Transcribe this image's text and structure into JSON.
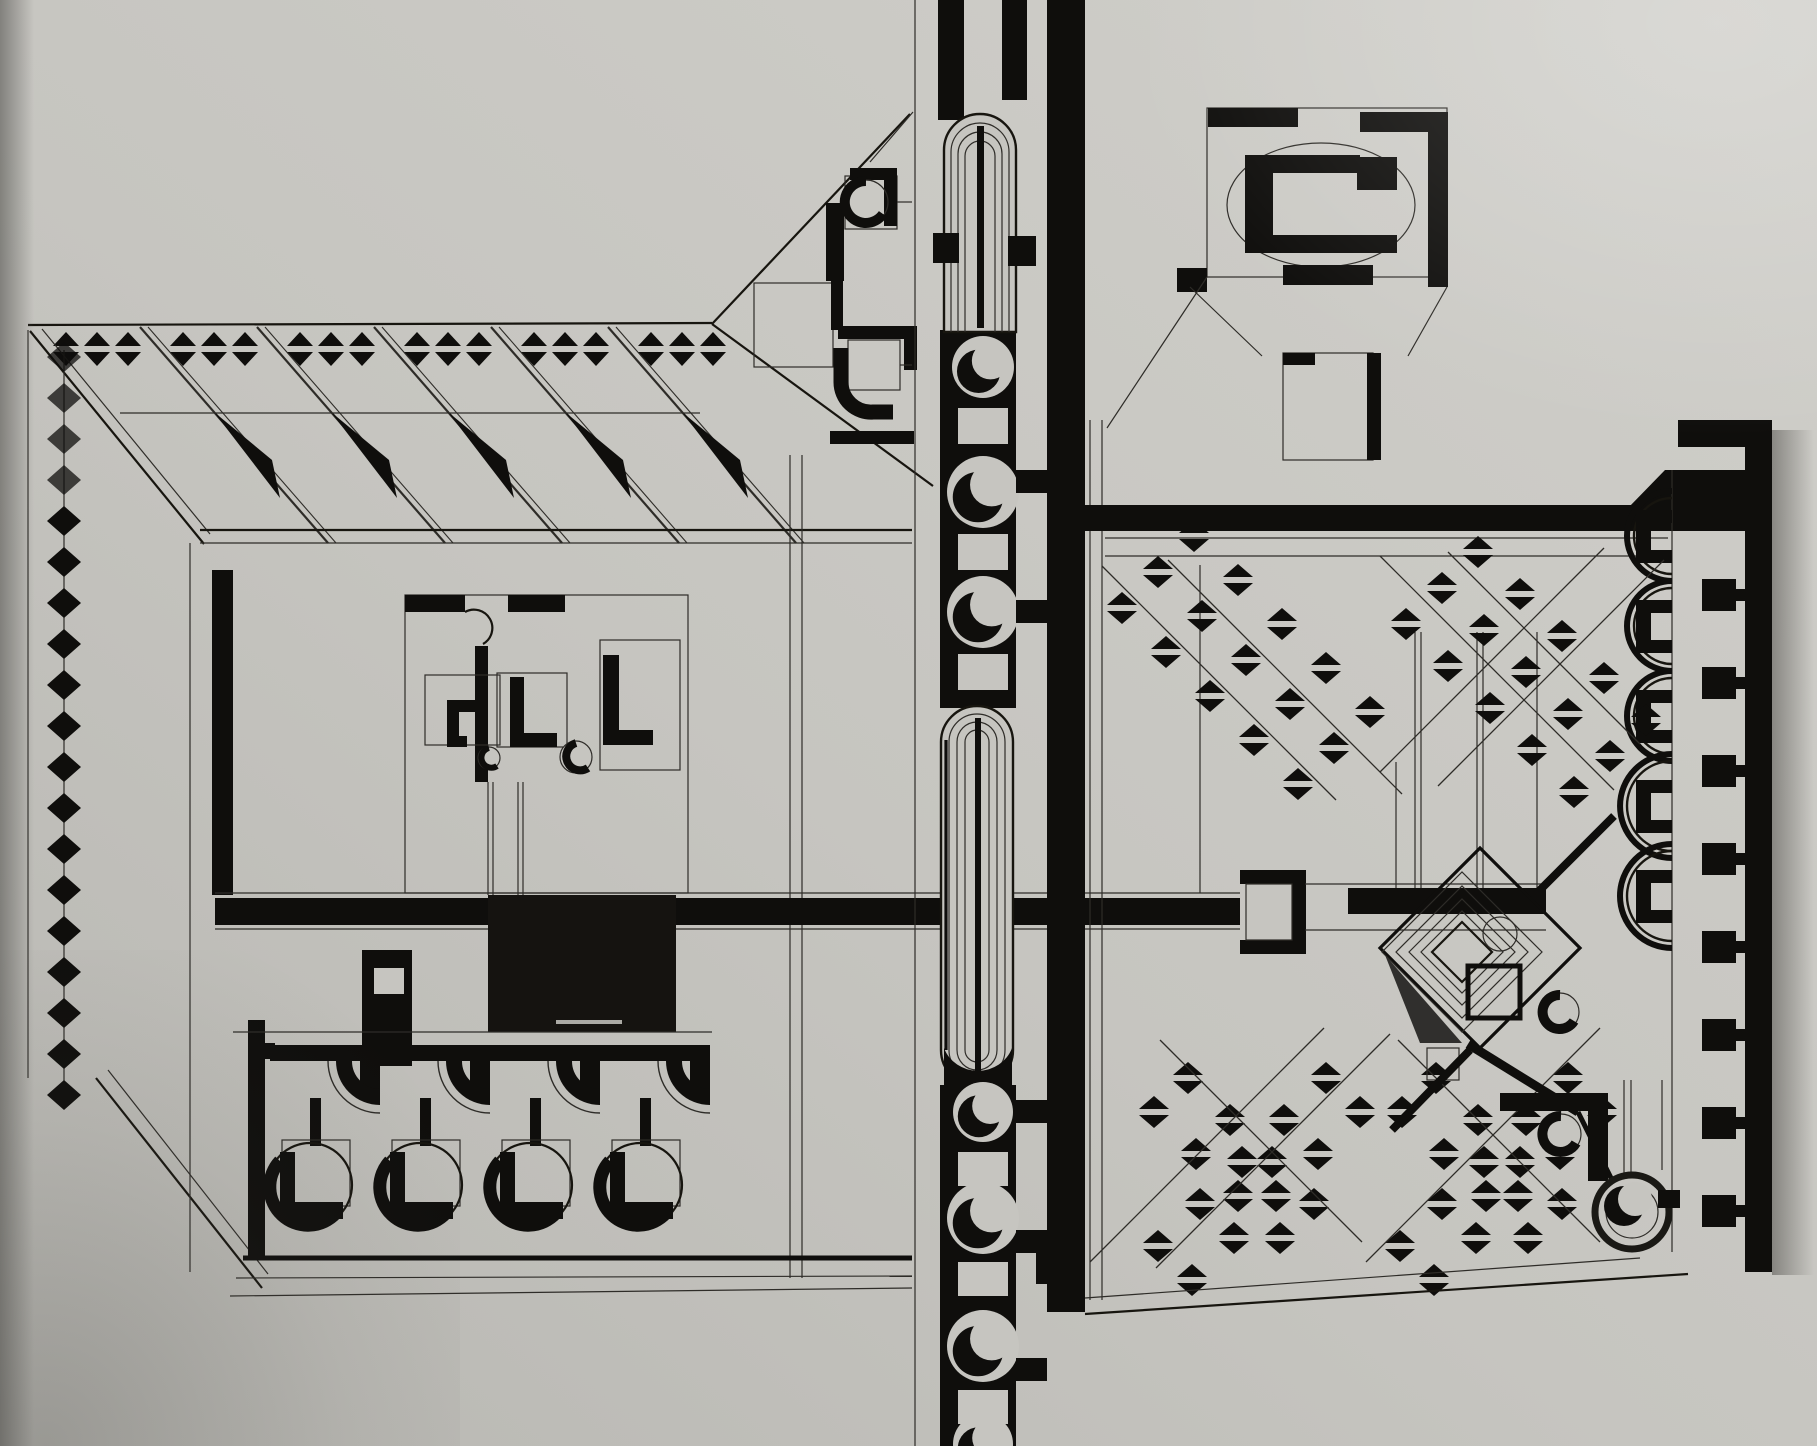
{
  "meta": {
    "label": "constructivist axonometric plan drawing, black ink on grey photographic paper"
  },
  "palette": {
    "paper": "#c6c5c0",
    "paper_light": "#d4d3ce",
    "paper_dark": "#b2b1ad",
    "edge_shadow": "#706f6b",
    "ink": "#0f0e0c",
    "line": "#2e2c28",
    "panel": "#151310"
  },
  "frieze": {
    "groups": [
      53,
      170,
      287,
      404,
      521,
      638
    ],
    "pairs": 3,
    "pitch": 31,
    "tri_w": 26,
    "tri_h": 14,
    "cy": 349
  },
  "hatch": {
    "xs": [
      140,
      257,
      374,
      491,
      608
    ],
    "top_y": 327,
    "dx": 188,
    "dy": 216
  },
  "left_column": {
    "cx": 64,
    "y0": 357,
    "pitch": 41,
    "count": 19,
    "w": 34,
    "h": 30
  },
  "colonnade": {
    "bays": 4,
    "x0": 253,
    "pitch": 110,
    "bar_y": 1045,
    "circle_cy": 1185,
    "circle_r": 42
  },
  "spine": {
    "upper_circles": [
      {
        "cy": 367,
        "r": 31
      },
      {
        "cy": 492,
        "r": 36
      },
      {
        "cy": 612,
        "r": 36
      }
    ],
    "upper_blocks": [
      408,
      534,
      654
    ],
    "lower_circles": [
      {
        "cy": 1112,
        "r": 30
      },
      {
        "cy": 1218,
        "r": 36
      },
      {
        "cy": 1346,
        "r": 36
      },
      {
        "cy": 1444,
        "r": 30
      }
    ],
    "lower_blocks": [
      1152,
      1262,
      1390
    ],
    "connectors": [
      470,
      600,
      1100,
      1230,
      1358
    ]
  },
  "right_wall": {
    "stud_cys": [
      507,
      595,
      683,
      771,
      859,
      947,
      1035,
      1123,
      1211
    ],
    "apses": [
      {
        "cy": 536,
        "r": 38
      },
      {
        "cy": 626,
        "r": 38
      },
      {
        "cy": 716,
        "r": 38
      },
      {
        "cy": 806,
        "r": 45
      },
      {
        "cy": 896,
        "r": 45
      }
    ]
  },
  "diamond_runs": [
    {
      "x": 1122,
      "y": 608,
      "dx": 44,
      "dy": 44,
      "n": 5,
      "rows": 3,
      "rx": 36,
      "ry": -36
    },
    {
      "x": 1406,
      "y": 624,
      "dx": 42,
      "dy": 42,
      "n": 5,
      "rows": 3,
      "rx": 36,
      "ry": -36
    },
    {
      "x": 1158,
      "y": 1246,
      "dx": 42,
      "dy": -42,
      "n": 5,
      "rows": 2,
      "rx": 34,
      "ry": 34
    },
    {
      "x": 1188,
      "y": 1078,
      "dx": 42,
      "dy": 42,
      "n": 4,
      "rows": 2,
      "rx": -34,
      "ry": 34
    },
    {
      "x": 1400,
      "y": 1246,
      "dx": 42,
      "dy": -42,
      "n": 5,
      "rows": 2,
      "rx": 34,
      "ry": 34
    },
    {
      "x": 1436,
      "y": 1078,
      "dx": 42,
      "dy": 42,
      "n": 4,
      "rows": 2,
      "rx": -34,
      "ry": 34
    }
  ],
  "guides": [
    [
      1102,
      566,
      1336,
      800
    ],
    [
      1168,
      560,
      1402,
      794
    ],
    [
      1380,
      556,
      1614,
      790
    ],
    [
      1448,
      552,
      1640,
      744
    ],
    [
      1664,
      560,
      1438,
      786
    ],
    [
      1604,
      548,
      1380,
      772
    ],
    [
      1090,
      1262,
      1324,
      1028
    ],
    [
      1156,
      1268,
      1390,
      1034
    ],
    [
      1366,
      1262,
      1600,
      1028
    ],
    [
      1398,
      1040,
      1600,
      1242
    ],
    [
      1160,
      1040,
      1362,
      1242
    ]
  ]
}
